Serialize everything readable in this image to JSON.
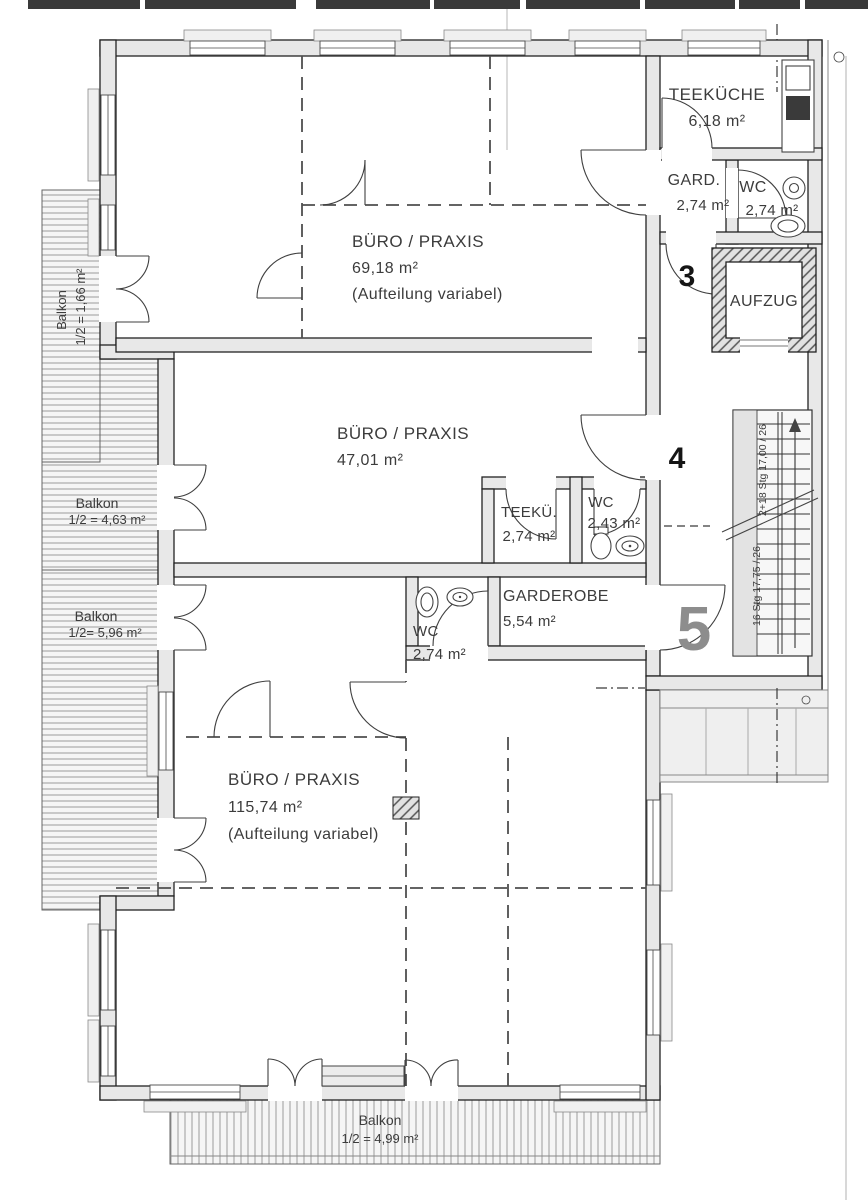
{
  "rooms": [
    {
      "id": "teekueche-top",
      "label": "TEEKÜCHE",
      "area": "6,18 m²"
    },
    {
      "id": "garderobe-top",
      "label": "GARD.",
      "area": "2,74 m²"
    },
    {
      "id": "wc-top",
      "label": "WC",
      "area": "2,74 m²"
    },
    {
      "id": "buero-top",
      "label": "BÜRO / PRAXIS",
      "area": "69,18 m²",
      "note": "(Aufteilung variabel)"
    },
    {
      "id": "aufzug",
      "label": "AUFZUG"
    },
    {
      "id": "buero-mid",
      "label": "BÜRO / PRAXIS",
      "area": "47,01 m²"
    },
    {
      "id": "teekueche-mid",
      "label": "TEEKÜ.",
      "area": "2,74 m²"
    },
    {
      "id": "wc-mid",
      "label": "WC",
      "area": "2,43 m²"
    },
    {
      "id": "garderobe-mid",
      "label": "GARDEROBE",
      "area": "5,54 m²"
    },
    {
      "id": "wc-lower",
      "label": "WC",
      "area": "2,74 m²"
    },
    {
      "id": "buero-bottom",
      "label": "BÜRO / PRAXIS",
      "area": "115,74 m²",
      "note": "(Aufteilung variabel)"
    }
  ],
  "balconies": [
    {
      "id": "balkon-top-left",
      "label": "Balkon",
      "area": "1/2 = 1,66 m²"
    },
    {
      "id": "balkon-mid-left",
      "label": "Balkon",
      "area": "1/2 = 4,63 m²"
    },
    {
      "id": "balkon-low-left",
      "label": "Balkon",
      "area": "1/2= 5,96 m²"
    },
    {
      "id": "balkon-bottom",
      "label": "Balkon",
      "area": "1/2 = 4,99 m²"
    }
  ],
  "markers": {
    "lobby": "3",
    "mid": "4",
    "lower": "5"
  },
  "stairs": {
    "flight_upper": "2+18 Stg 17,00 / 26",
    "flight_lower": "16 Stg 17,75 / 26"
  },
  "colors": {
    "wall_fill": "#e8e8e8",
    "line": "#222222",
    "text": "#3c3c3c",
    "marker_gray": "#8d8d8d"
  }
}
